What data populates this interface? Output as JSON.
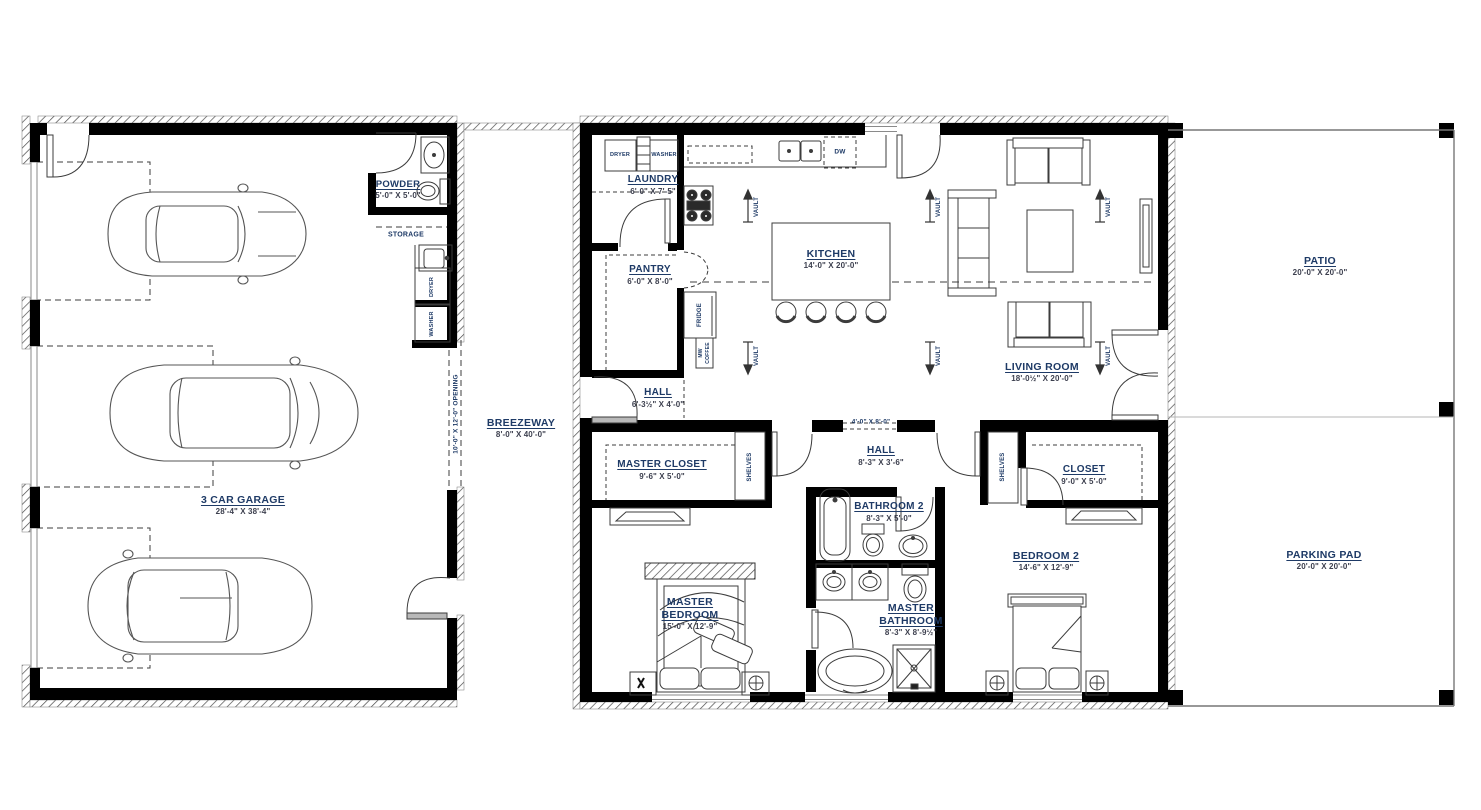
{
  "plan": {
    "rooms": {
      "garage": {
        "name": "3 CAR GARAGE",
        "dims": "28'-4\" X 38'-4\""
      },
      "powder": {
        "name": "POWDER",
        "dims": "5'-0\" X 5'-0\""
      },
      "breezeway": {
        "name": "BREEZEWAY",
        "dims": "8'-0\" X 40'-0\""
      },
      "laundry": {
        "name": "LAUNDRY",
        "dims": "6'-0\" X 7'-5\""
      },
      "pantry": {
        "name": "PANTRY",
        "dims": "6'-0\" X 8'-0\""
      },
      "hall1": {
        "name": "HALL",
        "dims": "6'-3½\" X 4'-0\""
      },
      "kitchen": {
        "name": "KITCHEN",
        "dims": "14'-0\" X 20'-0\""
      },
      "living_room": {
        "name": "LIVING ROOM",
        "dims": "18'-0½\" X 20'-0\""
      },
      "hall2": {
        "name": "HALL",
        "dims": "8'-3\" X 3'-6\""
      },
      "master_closet": {
        "name": "MASTER CLOSET",
        "dims": "9'-6\" X 5'-0\""
      },
      "closet": {
        "name": "CLOSET",
        "dims": "9'-0\" X 5'-0\""
      },
      "bathroom2": {
        "name": "BATHROOM 2",
        "dims": "8'-3\" X 5'-0\""
      },
      "master_bedroom": {
        "name": "MASTER BEDROOM",
        "dims": "15'-0\" X 12'-9\""
      },
      "master_bathroom": {
        "name": "MASTER BATHROOM",
        "dims": "8'-3\" X 8'-9½\""
      },
      "bedroom2": {
        "name": "BEDROOM 2",
        "dims": "14'-6\" X 12'-9\""
      },
      "patio": {
        "name": "PATIO",
        "dims": "20'-0\" X 20'-0\""
      },
      "parking_pad": {
        "name": "PARKING PAD",
        "dims": "20'-0\" X 20'-0\""
      }
    },
    "labels": {
      "storage": "STORAGE",
      "dryer": "DRYER",
      "washer": "WASHER",
      "fridge": "FRIDGE",
      "mw": "MW",
      "coffee": "COFFEE",
      "dw": "DW",
      "shelves": "SHELVES",
      "vault": "VAULT",
      "garage_opening": "10'-0\" X 12'-0\" OPENING",
      "hall_opening": "4'-0\" X 8'-0\""
    },
    "colors": {
      "label": "#1e3a66",
      "dims": "#3c3f4e",
      "wall": "#000000",
      "line": "#3c3c3c"
    }
  }
}
